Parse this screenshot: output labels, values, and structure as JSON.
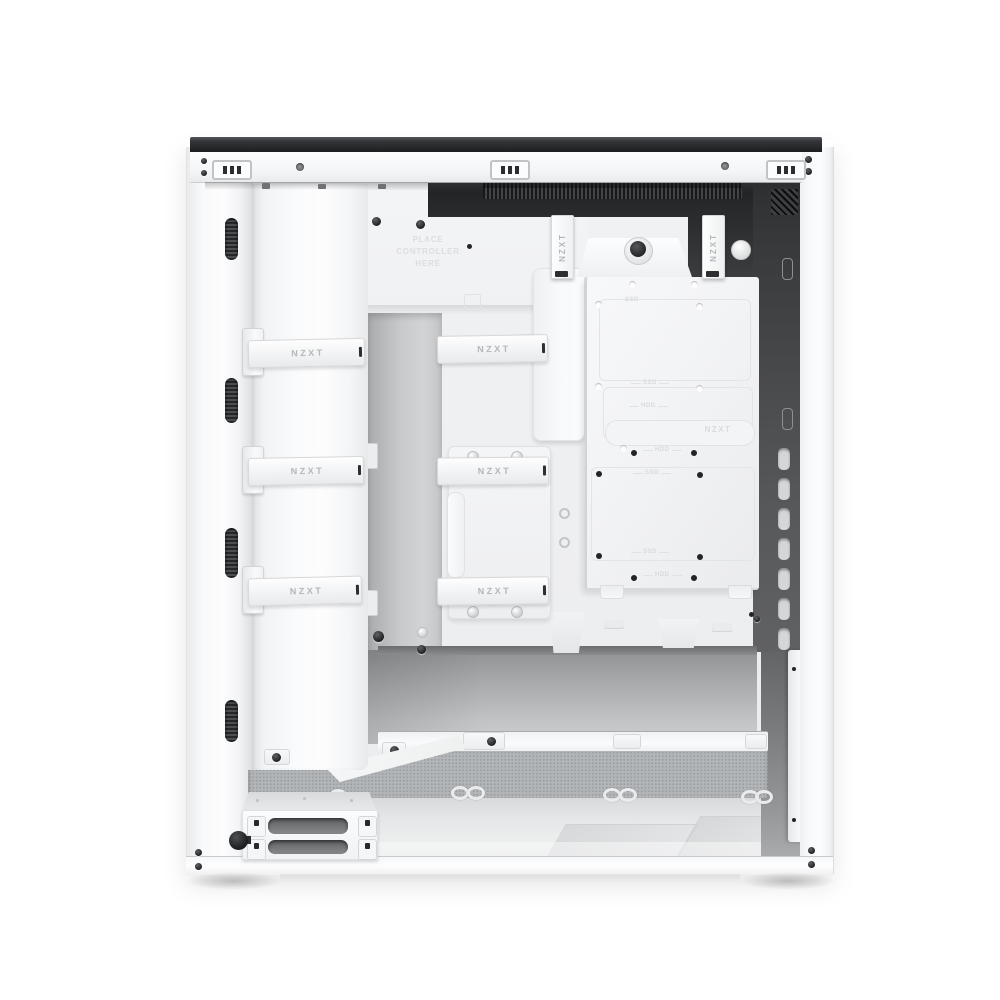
{
  "scene": {
    "type": "product-photo",
    "subject": "White NZXT mid-tower PC case with side panel removed, cable-management side view",
    "background_color": "#ffffff"
  },
  "brand": "NZXT",
  "labels": {
    "strap": "NZXT",
    "controller_note": [
      "PLACE",
      "CONTROLLER",
      "HERE"
    ],
    "tray_logo": "NZXT",
    "ssd": "SSD",
    "hdd": "HDD"
  },
  "colors": {
    "case_white": "#f7f8fa",
    "interior_gray": "#ecedef",
    "recess_dark": "#232426",
    "rear_panel_dark": "#4a4b4d",
    "mesh_gray": "#b2b5b7",
    "floor_gray": "#e4e5e7",
    "strap_text": "#b4b6b8",
    "emboss_text": "#dcdee0"
  }
}
